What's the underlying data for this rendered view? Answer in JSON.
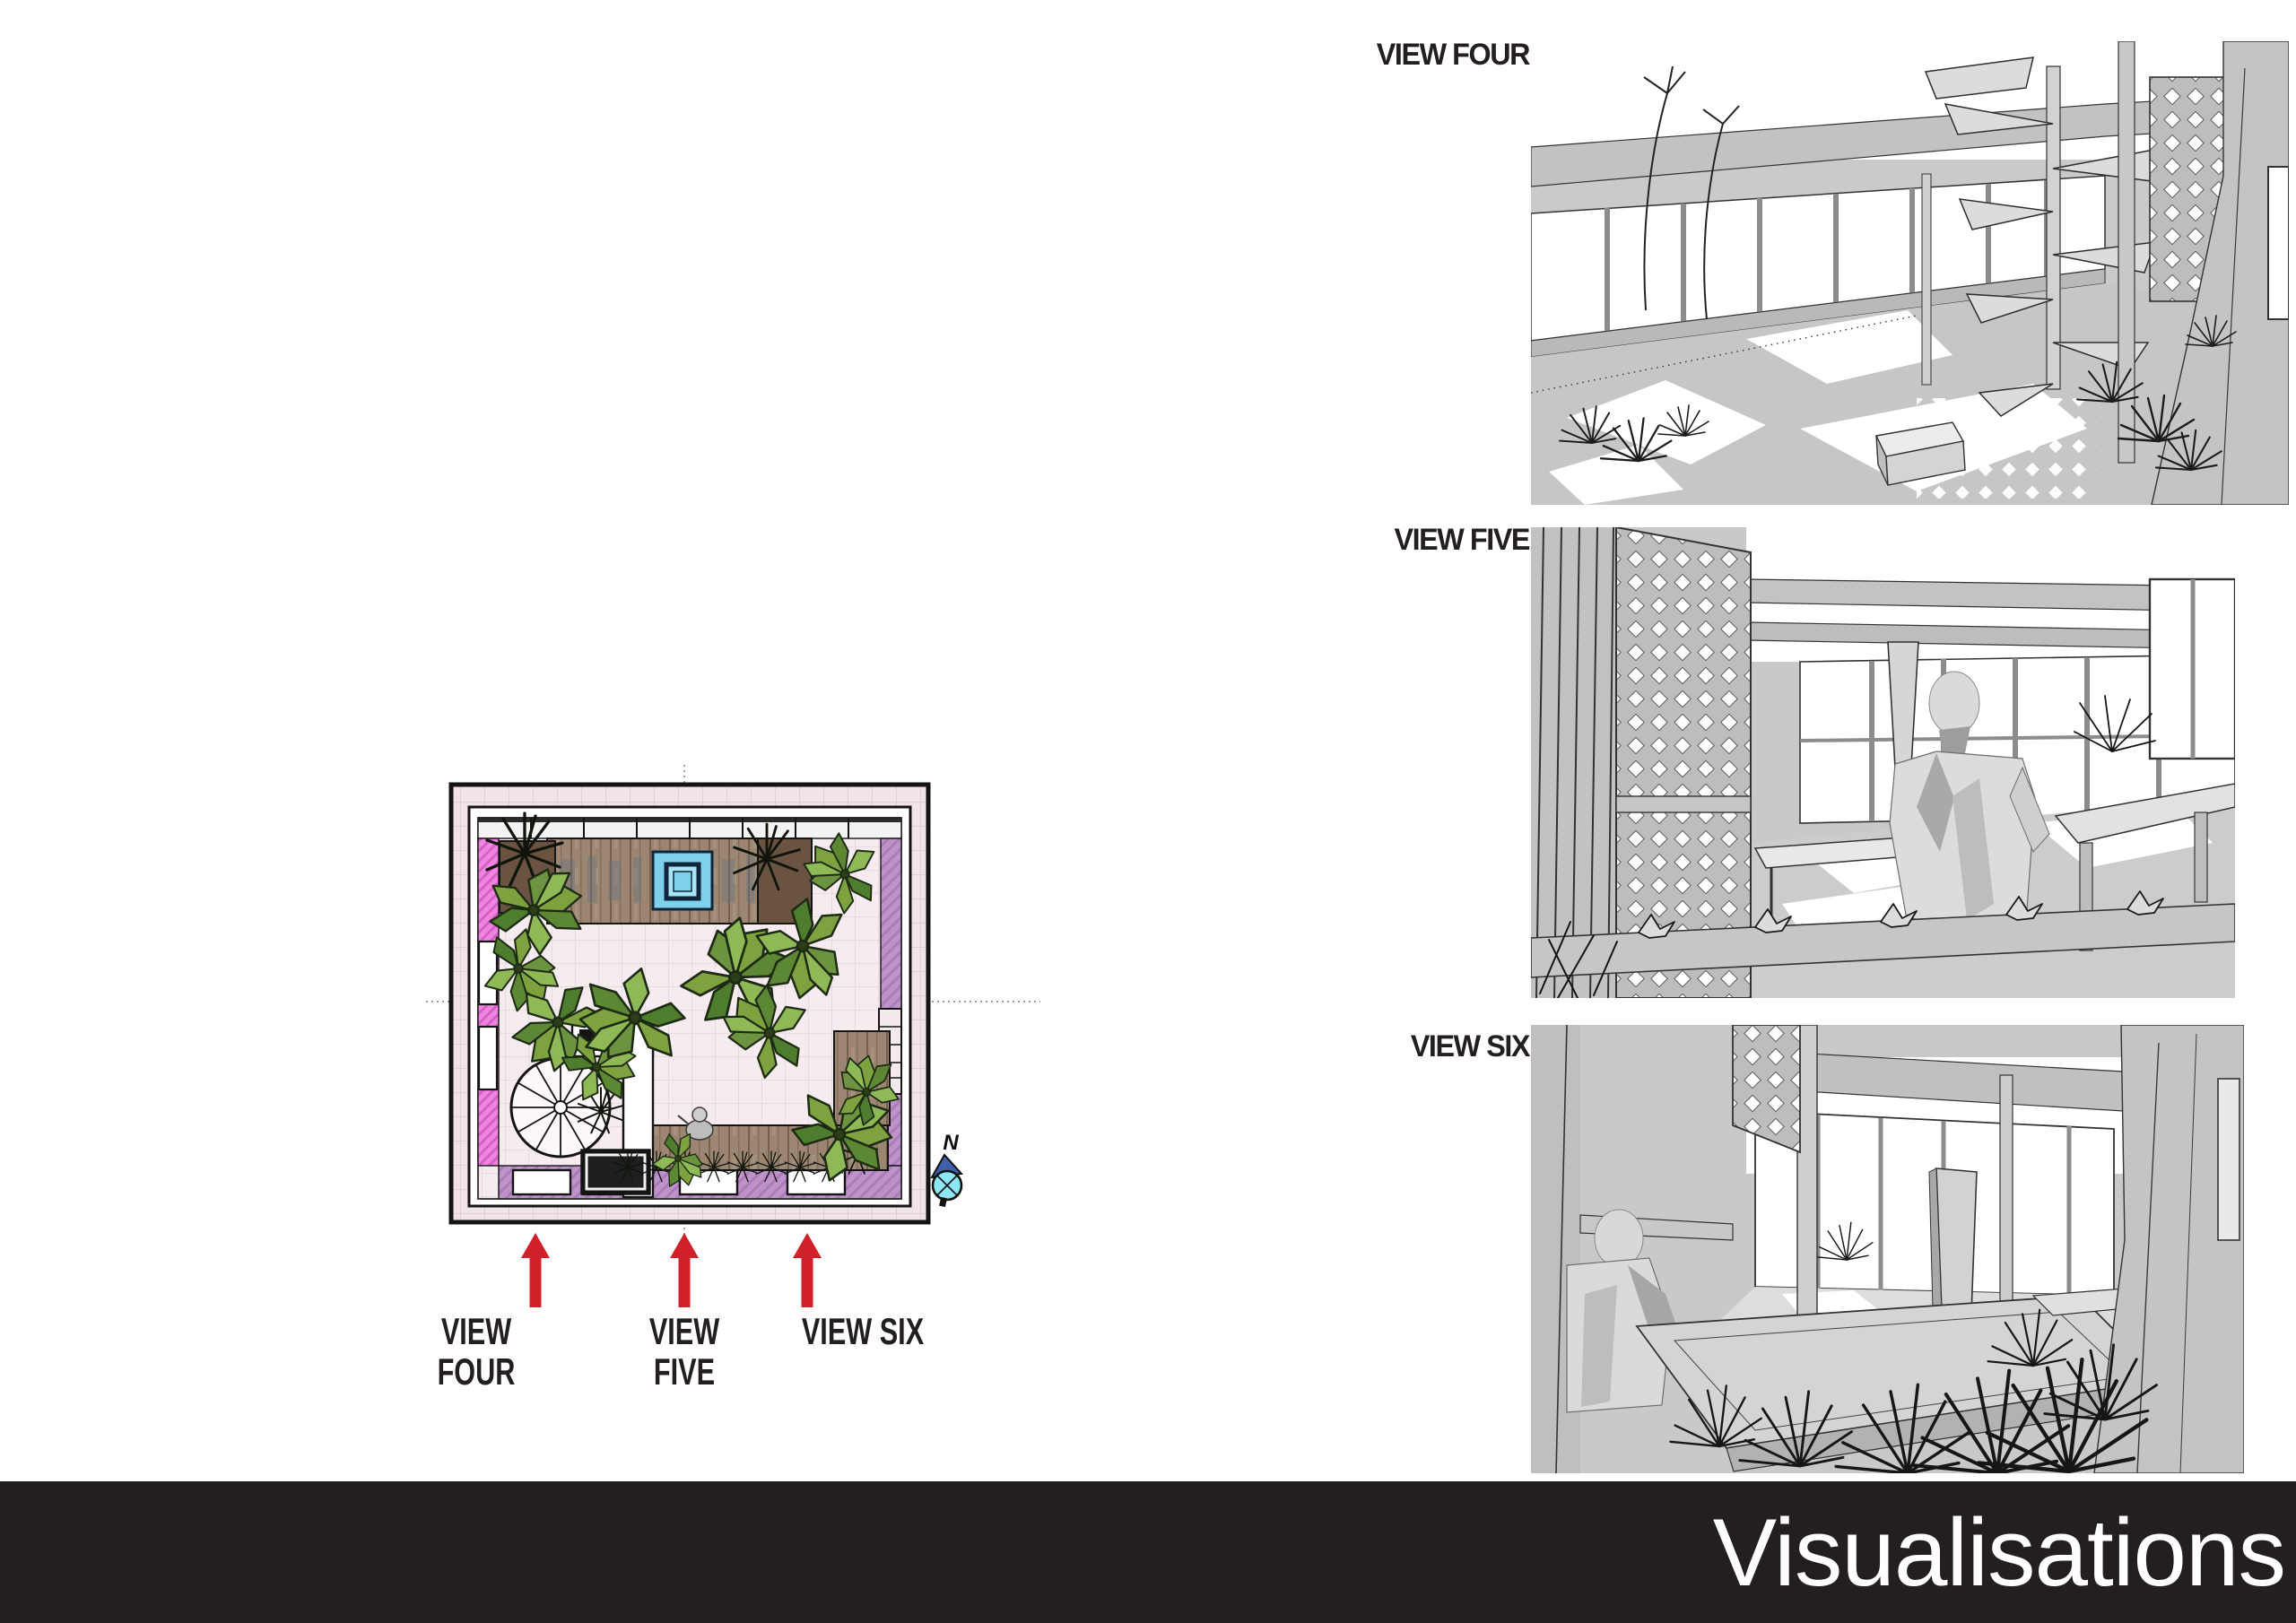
{
  "page": {
    "title": "Visualisations"
  },
  "plan": {
    "compass_label": "N",
    "arrow_labels": [
      "VIEW FOUR",
      "VIEW\nFIVE",
      "VIEW SIX"
    ]
  },
  "views": [
    {
      "id": "view-four",
      "label": "VIEW FOUR"
    },
    {
      "id": "view-five",
      "label": "VIEW FIVE"
    },
    {
      "id": "view-six",
      "label": "VIEW SIX"
    }
  ],
  "footer": {
    "title": "Visualisations"
  },
  "colors": {
    "accent_red": "#d0202a",
    "footer_bg": "#231f20",
    "label_text": "#231f20",
    "plan_tile_pink": "#f2e3e9",
    "plan_wall_pink": "#ee85de",
    "plan_wall_lavender": "#bd93c9",
    "plan_deck_wood": "#9c8672",
    "plan_pool_blue": "#7fd0ea",
    "plan_pool_frame": "#10263c",
    "plan_leaf_green": "#6f9c45",
    "compass_cyan": "#8de6f5",
    "compass_navy": "#3f5fa8",
    "render_gray": "#c9c9c9",
    "render_line": "#2e2e2e"
  }
}
